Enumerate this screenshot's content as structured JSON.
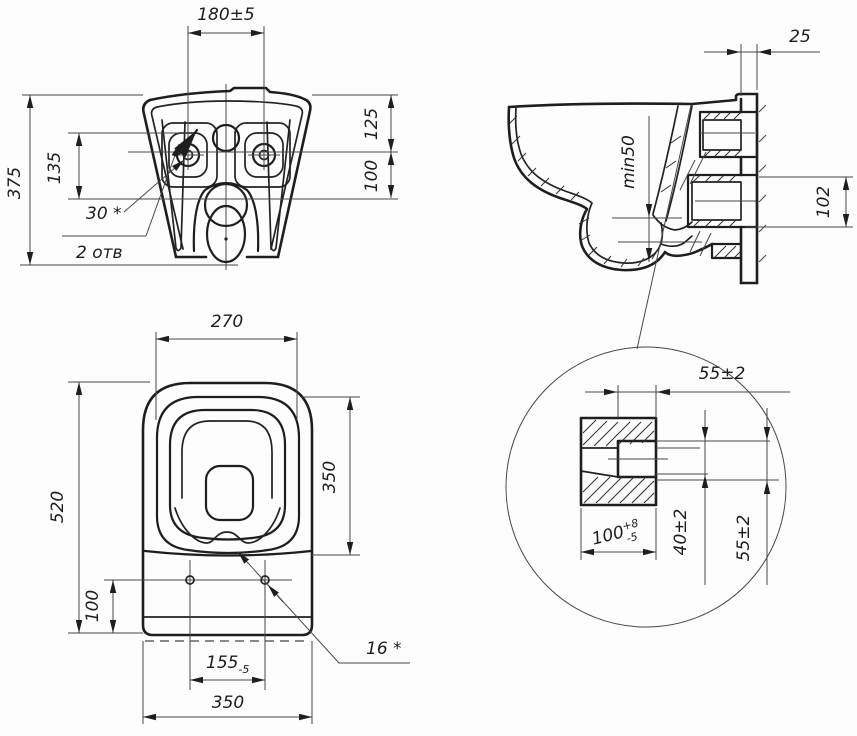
{
  "style": {
    "line_color": "#1e1e1e",
    "thin_color": "#474747",
    "background": "#fdfdfd"
  },
  "views": {
    "rear": {
      "dims": {
        "hole_spacing": "180±5",
        "height": "375",
        "boss_span": "135",
        "top_to_axis": "125",
        "axis_to_shelf": "100",
        "hole_angle_note": "30 *",
        "holes_note": "2 отв"
      }
    },
    "side": {
      "dims": {
        "wall_gap": "25",
        "water_seal": "min50",
        "outlet_height": "102"
      }
    },
    "plan": {
      "dims": {
        "seat_width": "270",
        "length": "520",
        "seat_length": "350",
        "holes_to_edge": "100",
        "hole_spacing": {
          "value": "155",
          "tol": "-5"
        },
        "width": "350",
        "hole_note": "16 *"
      }
    },
    "detail": {
      "dims": {
        "top_width": "55±2",
        "spigot": {
          "value": "100",
          "sup": "+8",
          "sub": "-5"
        },
        "inner_height": "40±2",
        "outer_height": "55±2"
      }
    }
  }
}
